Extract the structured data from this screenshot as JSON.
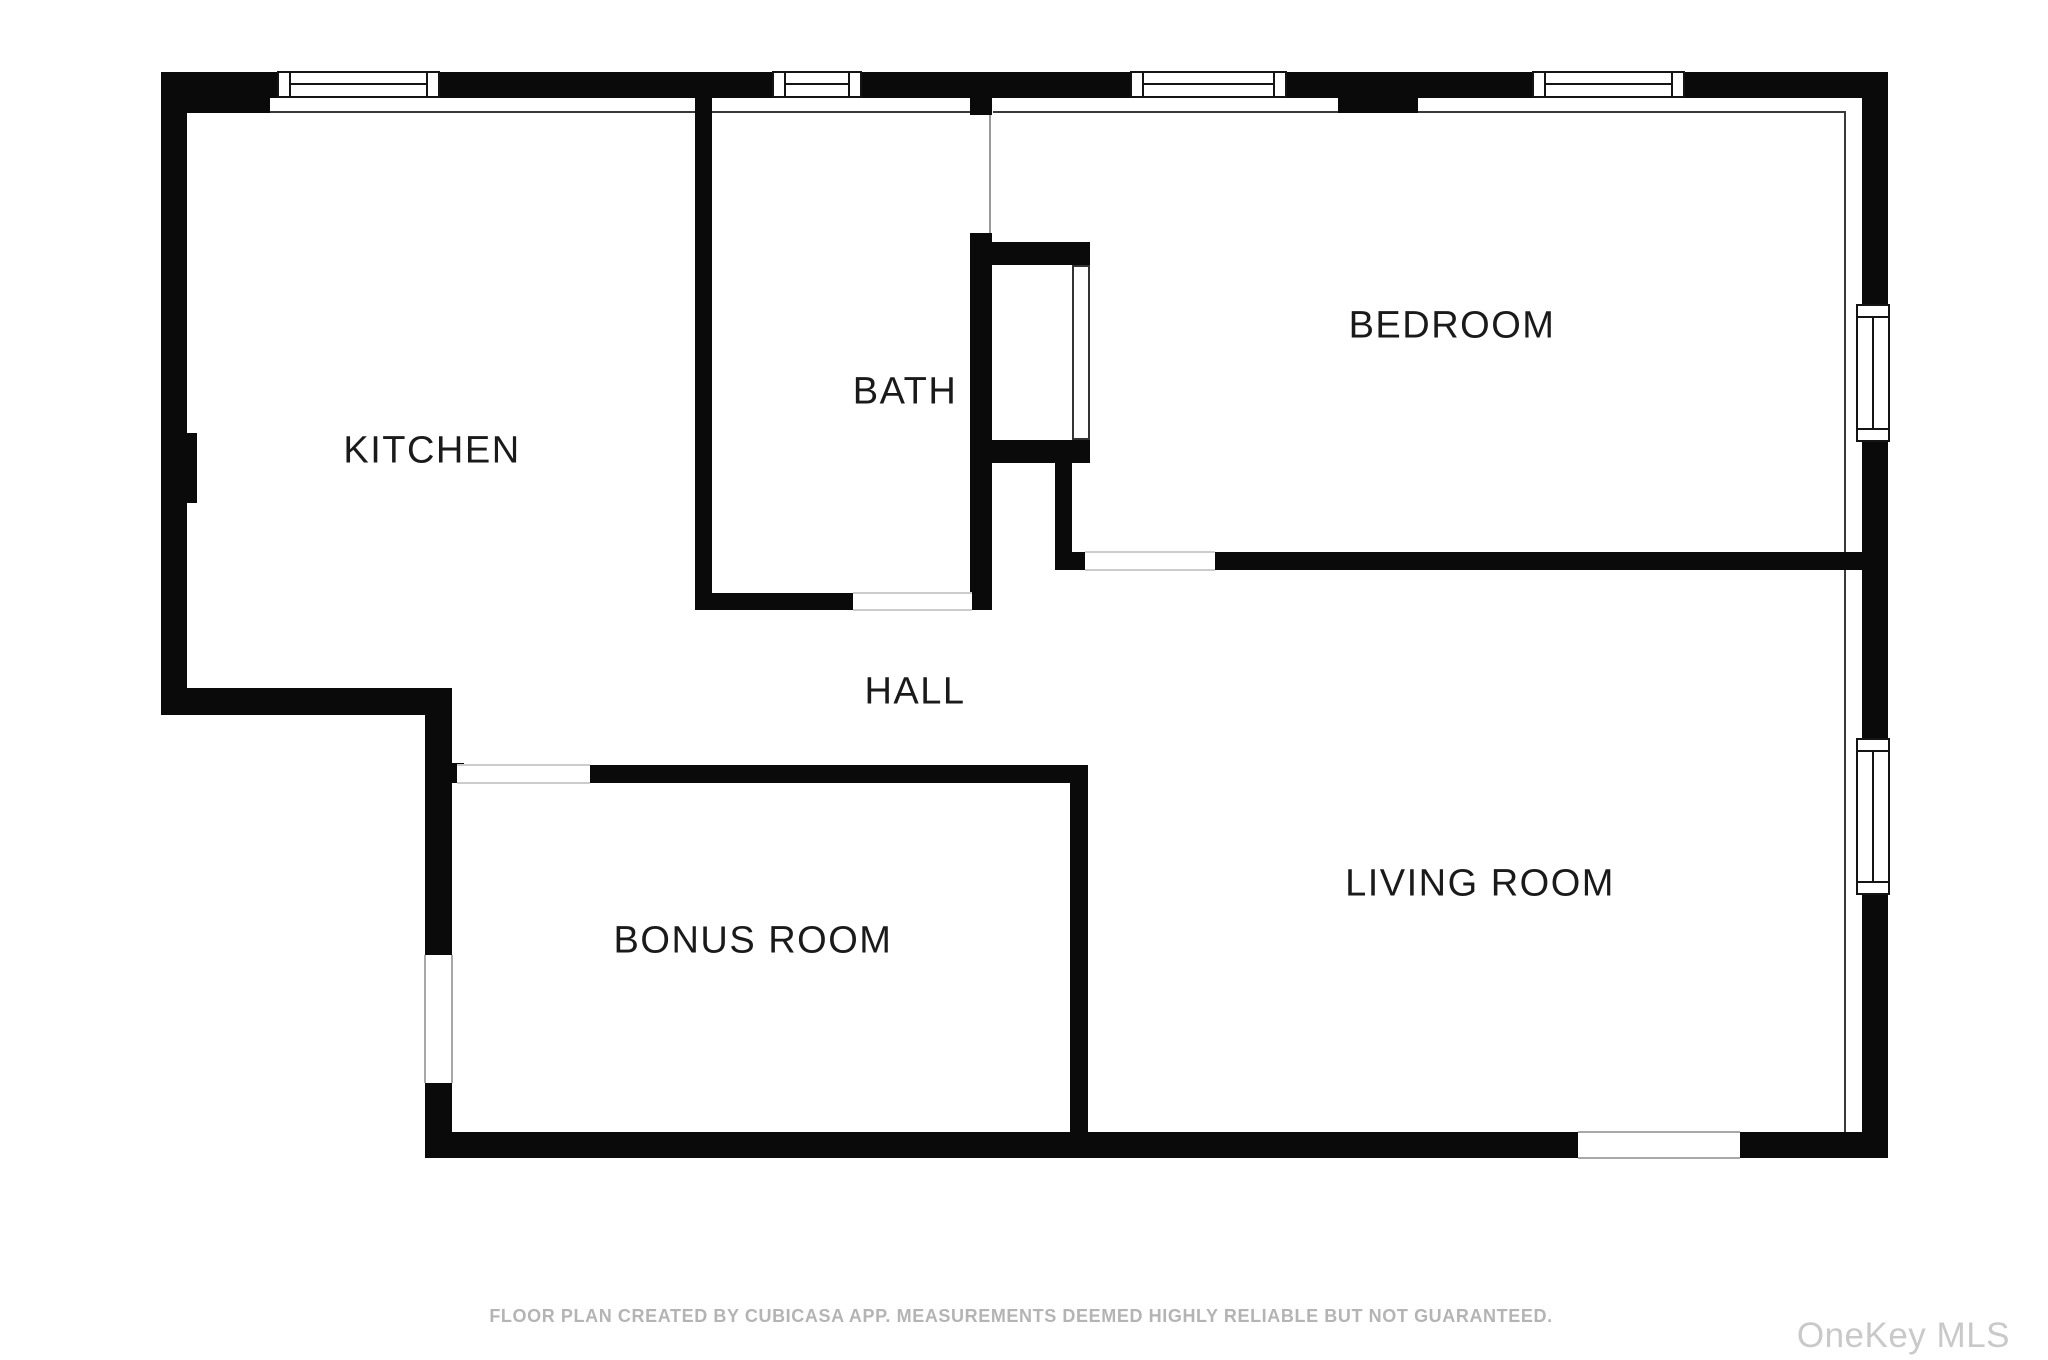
{
  "floor_plan": {
    "creator_app": "CubiCasa",
    "rooms": [
      {
        "id": "kitchen",
        "label": "KITCHEN"
      },
      {
        "id": "bath",
        "label": "BATH"
      },
      {
        "id": "bedroom",
        "label": "BEDROOM"
      },
      {
        "id": "hall",
        "label": "HALL"
      },
      {
        "id": "bonus-room",
        "label": "BONUS ROOM"
      },
      {
        "id": "living-room",
        "label": "LIVING ROOM"
      }
    ],
    "colors": {
      "wall": "#0a0a0a",
      "room_label": "#1a1a1a",
      "door_threshold": "#cccccc",
      "footer_text": "#b4b4b4",
      "watermark_text": "#c9c9c9",
      "background": "#ffffff"
    }
  },
  "footer": {
    "disclaimer": "FLOOR PLAN CREATED BY CUBICASA APP. MEASUREMENTS DEEMED HIGHLY RELIABLE BUT NOT GUARANTEED."
  },
  "watermark": {
    "text": "OneKey MLS"
  }
}
